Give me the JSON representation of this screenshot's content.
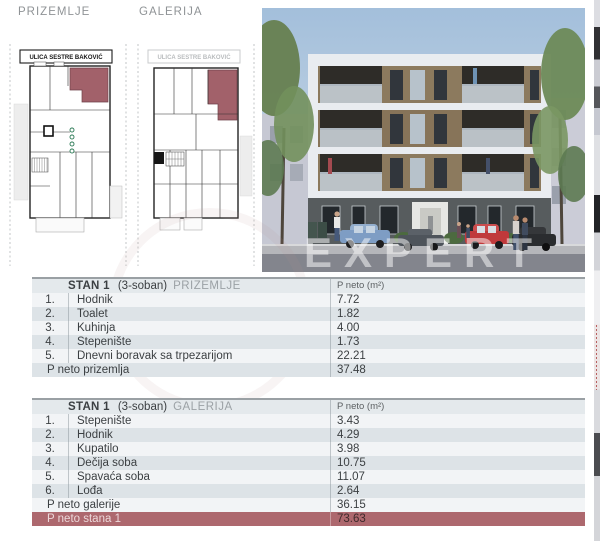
{
  "page_labels": {
    "plan1_title": "PRIZEMLJE",
    "plan2_title": "GALERIJA",
    "street_label": "ULICA SESTRE BAKOVIĆ",
    "watermark_main": "EXPERT",
    "watermark_sub": "n e k r e t n i n e"
  },
  "colors": {
    "row_light": "#f2f4f6",
    "row_dark": "#dde3e7",
    "header_bg": "#e4e9ec",
    "table_top_border": "#9aa0a4",
    "accent_maroon": "#ad686e",
    "plan_highlight_unit": "#a2616a",
    "text_dark": "#3b3f42",
    "text_muted": "#9ba1a5"
  },
  "tables": [
    {
      "title_unit": "STAN 1",
      "title_rooms": "(3-soban)",
      "title_level": "PRIZEMLJE",
      "area_header": "P neto (m²)",
      "rows": [
        {
          "num": "1.",
          "name": "Hodnik",
          "value": "7.72"
        },
        {
          "num": "2.",
          "name": "Toalet",
          "value": "1.82"
        },
        {
          "num": "3.",
          "name": "Kuhinja",
          "value": "4.00"
        },
        {
          "num": "4.",
          "name": "Stepenište",
          "value": "1.73"
        },
        {
          "num": "5.",
          "name": "Dnevni boravak sa trpezarijom",
          "value": "22.21"
        }
      ],
      "summary_rows": [
        {
          "label": "P neto prizemlja",
          "value": "37.48",
          "style": "normal"
        }
      ]
    },
    {
      "title_unit": "STAN 1",
      "title_rooms": "(3-soban)",
      "title_level": "GALERIJA",
      "area_header": "P neto (m²)",
      "rows": [
        {
          "num": "1.",
          "name": "Stepenište",
          "value": "3.43"
        },
        {
          "num": "2.",
          "name": "Hodnik",
          "value": "4.29"
        },
        {
          "num": "3.",
          "name": "Kupatilo",
          "value": "3.98"
        },
        {
          "num": "4.",
          "name": "Dečija soba",
          "value": "10.75"
        },
        {
          "num": "5.",
          "name": "Spavaća soba",
          "value": "11.07"
        },
        {
          "num": "6.",
          "name": "Lođa",
          "value": "2.64"
        }
      ],
      "summary_rows": [
        {
          "label": "P neto galerije",
          "value": "36.15",
          "style": "normal"
        },
        {
          "label": "P neto stana 1",
          "value": "73.63",
          "style": "highlight"
        }
      ]
    }
  ]
}
